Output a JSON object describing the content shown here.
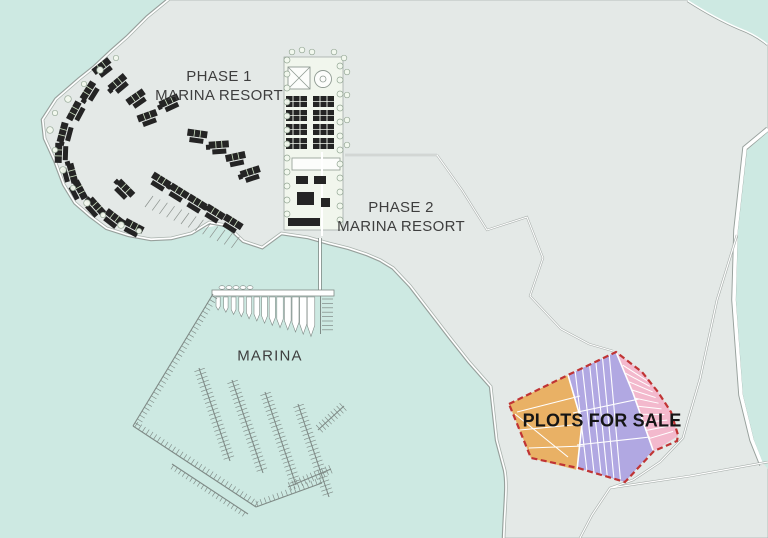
{
  "image_title": "Marina resort development site plan",
  "labels": {
    "phase1": {
      "line1": "PHASE 1",
      "line2": "MARINA RESORT"
    },
    "phase2": {
      "line1": "PHASE 2",
      "line2": "MARINA RESORT"
    },
    "marina": {
      "label": "MARINA"
    },
    "plots": {
      "label": "PLOTS FOR SALE"
    }
  },
  "areas": [
    {
      "id": "phase-1-marina-resort",
      "type": "resort",
      "color": "#c9f0b5"
    },
    {
      "id": "phase-2-marina-resort",
      "type": "resort",
      "color": "#c9f0b5"
    },
    {
      "id": "marina",
      "type": "marina-docks"
    },
    {
      "id": "plots-for-sale",
      "type": "land-plots",
      "plot_colors": [
        "#e9b165",
        "#b1a8e2",
        "#f3b9cd"
      ],
      "border": "#c03434"
    }
  ],
  "colors": {
    "water": "#cde9e2",
    "land": "#e4e9e7",
    "coast_gray": "#97a09c",
    "green": "#c9f0b5",
    "strip": "#f1f6ed",
    "building": "#242424",
    "orange": "#e9b165",
    "purple": "#b1a8e2",
    "pink": "#f3b9cd",
    "red_dash": "#c03434",
    "road": "#ffffff",
    "label_text": "#3e3e3e",
    "plots_text": "#151515"
  }
}
